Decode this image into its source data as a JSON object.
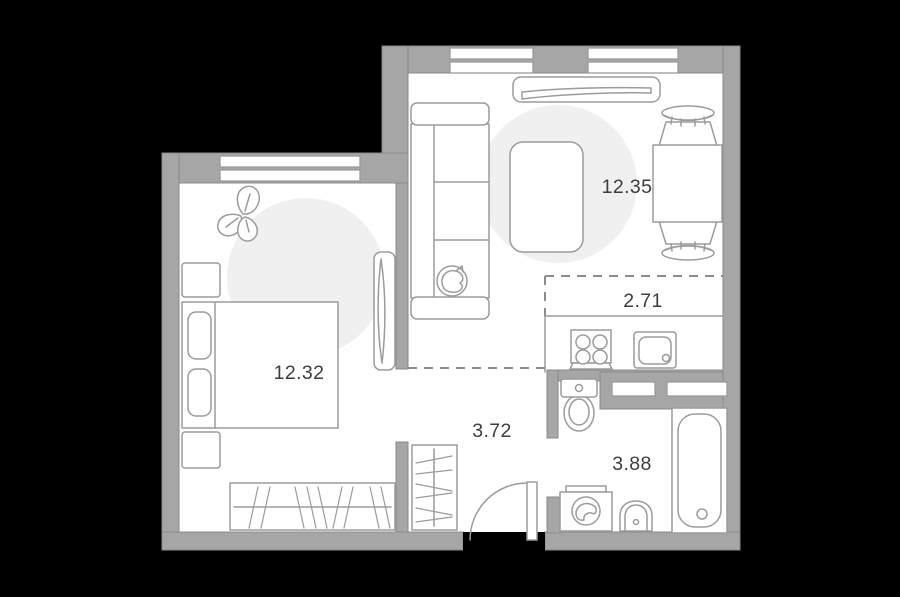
{
  "plan_title": "apartment-floor-plan",
  "rooms": {
    "living_room": {
      "area_label": "12.35"
    },
    "kitchen_zone": {
      "area_label": "2.71"
    },
    "bedroom": {
      "area_label": "12.32"
    },
    "hallway": {
      "area_label": "3.72"
    },
    "bathroom": {
      "area_label": "3.88"
    }
  },
  "colors": {
    "background": "#000000",
    "wall": "#a6a6a6",
    "wall_outline": "#898989",
    "floor": "#ffffff",
    "furniture_stroke": "#9b9b9b",
    "spotlight": "#f0f0f0",
    "dashed_line": "#8c8c8c",
    "label": "#3d3d3d"
  }
}
